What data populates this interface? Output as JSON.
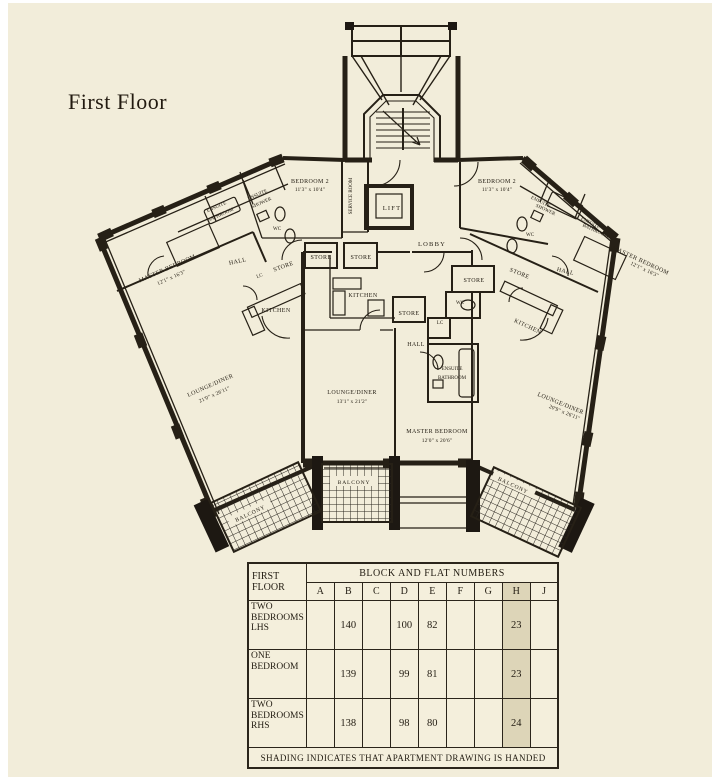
{
  "title": "First Floor",
  "plan": {
    "labels": {
      "service_room": "SERVICE ROOM",
      "lift": "LIFT",
      "lobby": "LOBBY",
      "hall": "HALL",
      "kitchen": "KITCHEN",
      "store": "STORE",
      "wc": "WC",
      "lc": "LC",
      "balcony": "BALCONY",
      "ensuite": "ENSUITE",
      "bathroom": "BATHROOM",
      "shower": "SHOWER"
    },
    "rooms": {
      "bedroom2_left": {
        "name": "BEDROOM 2",
        "dims": "11'3\" x 10'4\""
      },
      "bedroom2_right": {
        "name": "BEDROOM 2",
        "dims": "11'3\" x 10'4\""
      },
      "master_left": {
        "name": "MASTER BEDROOM",
        "dims": "12'1\" x 16'3\""
      },
      "master_right": {
        "name": "MASTER BEDROOM",
        "dims": "12'1\" x 16'3\""
      },
      "master_center": {
        "name": "MASTER BEDROOM",
        "dims": "12'0\" x 20'6\""
      },
      "lounge_left": {
        "name": "LOUNGE/DINER",
        "dims": "21'0\" x 26'11\""
      },
      "lounge_center": {
        "name": "LOUNGE/DINER",
        "dims": "13'1\" x 21'2\""
      },
      "lounge_right": {
        "name": "LOUNGE/DINER",
        "dims": "20'9\" x 26'11\""
      }
    },
    "ink_color": "#262016",
    "paper_color": "#f2edda"
  },
  "table": {
    "corner_line1": "FIRST",
    "corner_line2": "FLOOR",
    "span_header": "BLOCK AND FLAT NUMBERS",
    "columns": [
      "A",
      "B",
      "C",
      "D",
      "E",
      "F",
      "G",
      "H",
      "J"
    ],
    "shaded_column": "H",
    "rows": [
      {
        "label": "TWO BEDROOMS LHS",
        "values": {
          "B": "140",
          "D": "100",
          "E": "82",
          "H": "23"
        }
      },
      {
        "label": "ONE BEDROOM",
        "values": {
          "B": "139",
          "D": "99",
          "E": "81",
          "H": "23"
        }
      },
      {
        "label": "TWO BEDROOMS RHS",
        "values": {
          "B": "138",
          "D": "98",
          "E": "80",
          "H": "24"
        }
      }
    ],
    "footer": "SHADING INDICATES THAT APARTMENT DRAWING IS HANDED"
  }
}
